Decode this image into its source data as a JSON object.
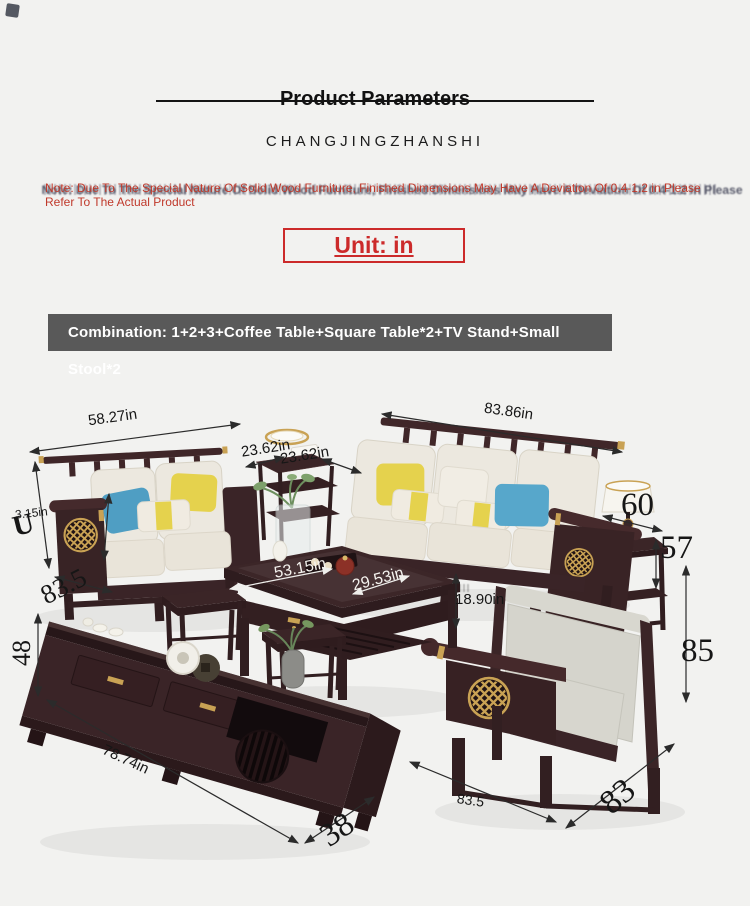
{
  "header": {
    "title": "Product Parameters",
    "brand": "CHANGJINGZHANSHI",
    "note_line1": "Note: Due To The Special Nature Of Solid Wood Furniture, Finished Dimensions May Have A Deviation Of 0.4-1.2 in Please",
    "note_line2": "Refer To The Actual Product",
    "unit_label": "Unit: in",
    "combination_label": "Combination: 1+2+3+Coffee Table+Square Table*2+TV Stand+Small Stool*2"
  },
  "colors": {
    "background": "#f2f2f0",
    "accent_red": "#c0392b",
    "unit_red": "#cc2a2a",
    "banner_gray": "#595959",
    "wood_dark": "#3a2427",
    "gold": "#c9a254",
    "cushion_cream": "#ece8df",
    "armchair_gray": "#d5d4cc",
    "pillow_yellow": "#e5d24d",
    "pillow_blue": "#57a7cb"
  },
  "diagram": {
    "description": "Living room solid wood furniture set with dimension callouts",
    "dims": [
      {
        "id": "sofa-2seat-width",
        "label": "58.27in"
      },
      {
        "id": "sofa-3seat-width",
        "label": "83.86in"
      },
      {
        "id": "square-table-width",
        "label": "23.62in"
      },
      {
        "id": "square-table-depth",
        "label": "23.62in"
      },
      {
        "id": "armrest-width",
        "label": "3.15in"
      },
      {
        "id": "stray-glyph",
        "label": "U"
      },
      {
        "id": "sofa-depth",
        "label": "83.5"
      },
      {
        "id": "tv-stand-height",
        "label": "48"
      },
      {
        "id": "coffee-table-length",
        "label": "53.15in"
      },
      {
        "id": "coffee-table-depth",
        "label": "29.53in"
      },
      {
        "id": "coffee-table-height",
        "label": "18.90in"
      },
      {
        "id": "lamp-table-dim",
        "label": "60"
      },
      {
        "id": "side-table-height",
        "label": "57"
      },
      {
        "id": "armchair-back-height",
        "label": "85"
      },
      {
        "id": "tv-stand-length",
        "label": "78.74in"
      },
      {
        "id": "tv-stand-depth",
        "label": "38"
      },
      {
        "id": "armchair-width",
        "label": "83.5"
      },
      {
        "id": "armchair-depth",
        "label": "83"
      }
    ]
  }
}
